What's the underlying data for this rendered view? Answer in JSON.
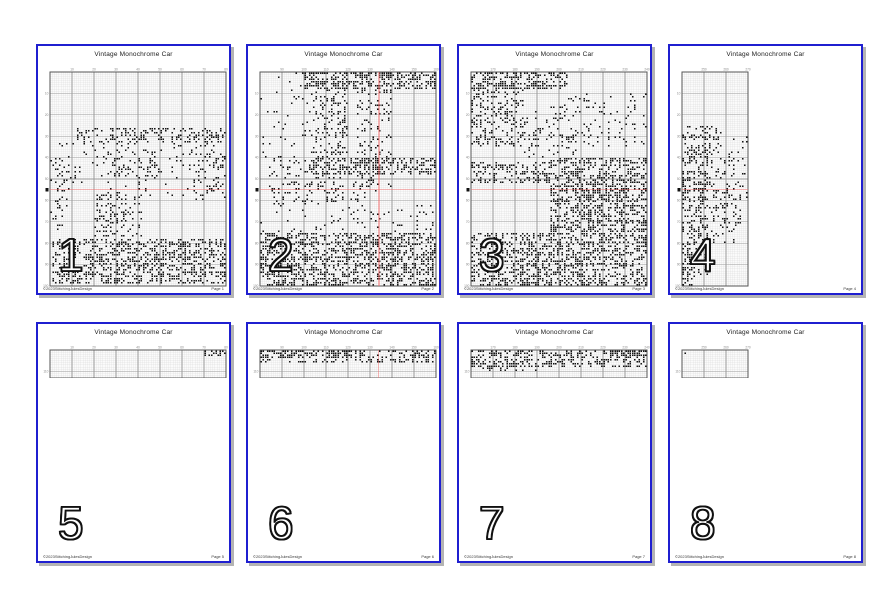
{
  "document_title": "Vintage Monochrome Car",
  "colors": {
    "page_border": "#1f1fd0",
    "grid_minor": "#dcdcdc",
    "grid_major": "#9a9a9a",
    "grid_border": "#555555",
    "stitch_mark": "#141414",
    "center_line_red": "#ef6b6b",
    "shadow": "#b4b4b4"
  },
  "pages": [
    {
      "number": "1",
      "title": "Vintage Monochrome Car",
      "footer_left": "©2023StitchingJulesDesign",
      "footer_right": "Page 1",
      "grid": {
        "cols": 80,
        "rows": 100,
        "seed": 101,
        "col_labels": [
          10,
          20,
          30,
          40,
          50,
          60,
          70,
          80
        ],
        "row_labels": [
          10,
          20,
          30,
          40,
          50,
          60,
          70,
          80,
          90,
          100
        ],
        "red_h": 0.55,
        "red_v": null,
        "left_marker": true,
        "regions": [
          [
            0.16,
            0.97,
            0.26,
            0.33,
            0.3
          ],
          [
            0.05,
            0.98,
            0.33,
            0.58,
            0.08
          ],
          [
            0.33,
            0.62,
            0.36,
            0.5,
            0.14
          ],
          [
            0.82,
            1.0,
            0.28,
            0.6,
            0.15
          ],
          [
            0.0,
            0.1,
            0.4,
            0.75,
            0.12
          ],
          [
            0.25,
            0.52,
            0.58,
            0.77,
            0.22
          ],
          [
            0.02,
            1.0,
            0.78,
            0.99,
            0.42
          ]
        ]
      }
    },
    {
      "number": "2",
      "title": "Vintage Monochrome Car",
      "footer_left": "©2023StitchingJulesDesign",
      "footer_right": "Page 2",
      "grid": {
        "cols": 80,
        "rows": 100,
        "seed": 202,
        "col_labels": [
          90,
          100,
          110,
          120,
          130,
          140,
          150,
          160
        ],
        "row_labels": [
          10,
          20,
          30,
          40,
          50,
          60,
          70,
          80,
          90,
          100
        ],
        "red_h": 0.55,
        "red_v": 0.675,
        "left_marker": true,
        "regions": [
          [
            0.25,
            1.0,
            0.0,
            0.07,
            0.5
          ],
          [
            0.3,
            0.5,
            0.02,
            0.4,
            0.25
          ],
          [
            0.55,
            0.75,
            0.0,
            0.55,
            0.16
          ],
          [
            0.05,
            0.6,
            0.4,
            0.62,
            0.14
          ],
          [
            0.3,
            1.0,
            0.4,
            0.48,
            0.4
          ],
          [
            0.0,
            0.3,
            0.0,
            0.4,
            0.05
          ],
          [
            0.0,
            1.0,
            0.62,
            0.75,
            0.07
          ],
          [
            0.0,
            1.0,
            0.75,
            1.0,
            0.45
          ]
        ]
      }
    },
    {
      "number": "3",
      "title": "Vintage Monochrome Car",
      "footer_left": "©2023StitchingJulesDesign",
      "footer_right": "Page 3",
      "grid": {
        "cols": 80,
        "rows": 100,
        "seed": 303,
        "col_labels": [
          170,
          180,
          190,
          200,
          210,
          220,
          230,
          240
        ],
        "row_labels": [
          10,
          20,
          30,
          40,
          50,
          60,
          70,
          80,
          90,
          100
        ],
        "red_h": 0.55,
        "red_v": null,
        "left_marker": true,
        "regions": [
          [
            0.0,
            0.55,
            0.0,
            0.07,
            0.5
          ],
          [
            0.0,
            0.3,
            0.05,
            0.35,
            0.3
          ],
          [
            0.3,
            0.6,
            0.15,
            0.4,
            0.12
          ],
          [
            0.55,
            1.0,
            0.1,
            0.35,
            0.1
          ],
          [
            0.45,
            1.0,
            0.4,
            0.75,
            0.45
          ],
          [
            0.0,
            0.45,
            0.42,
            0.52,
            0.35
          ],
          [
            0.0,
            1.0,
            0.75,
            1.0,
            0.45
          ]
        ]
      }
    },
    {
      "number": "4",
      "title": "Vintage Monochrome Car",
      "footer_left": "©2023StitchingJulesDesign",
      "footer_right": "Page 4",
      "grid": {
        "cols": 30,
        "rows": 100,
        "seed": 404,
        "col_labels": [
          250,
          260,
          270
        ],
        "row_labels": [
          10,
          20,
          30,
          40,
          50,
          60,
          70,
          80,
          90,
          100
        ],
        "red_h": 0.55,
        "red_v": null,
        "left_marker": true,
        "regions": [
          [
            0.0,
            0.6,
            0.25,
            0.32,
            0.3
          ],
          [
            0.0,
            1.0,
            0.3,
            0.6,
            0.16
          ],
          [
            0.0,
            0.4,
            0.35,
            0.95,
            0.3
          ],
          [
            0.4,
            0.9,
            0.55,
            0.8,
            0.2
          ],
          [
            0.0,
            0.2,
            0.8,
            1.0,
            0.35
          ]
        ]
      }
    },
    {
      "number": "5",
      "title": "Vintage Monochrome Car",
      "footer_left": "©2023StitchingJulesDesign",
      "footer_right": "Page 5",
      "grid": {
        "cols": 80,
        "rows": 13,
        "seed": 505,
        "col_labels": [
          10,
          20,
          30,
          40,
          50,
          60,
          70,
          80
        ],
        "row_labels": [
          110
        ],
        "red_h": null,
        "red_v": null,
        "left_marker": false,
        "regions": [
          [
            0.88,
            1.0,
            0.0,
            0.18,
            0.5
          ]
        ]
      }
    },
    {
      "number": "6",
      "title": "Vintage Monochrome Car",
      "footer_left": "©2023StitchingJulesDesign",
      "footer_right": "Page 6",
      "grid": {
        "cols": 80,
        "rows": 13,
        "seed": 606,
        "col_labels": [
          90,
          100,
          110,
          120,
          130,
          140,
          150,
          160
        ],
        "row_labels": [
          110
        ],
        "red_h": null,
        "red_v": 0.675,
        "left_marker": false,
        "regions": [
          [
            0.0,
            1.0,
            0.0,
            0.45,
            0.3
          ],
          [
            0.0,
            0.55,
            0.0,
            0.3,
            0.45
          ]
        ]
      }
    },
    {
      "number": "7",
      "title": "Vintage Monochrome Car",
      "footer_left": "©2023StitchingJulesDesign",
      "footer_right": "Page 7",
      "grid": {
        "cols": 80,
        "rows": 13,
        "seed": 707,
        "col_labels": [
          170,
          180,
          190,
          200,
          210,
          220,
          230,
          240
        ],
        "row_labels": [
          110
        ],
        "red_h": null,
        "red_v": null,
        "left_marker": false,
        "regions": [
          [
            0.0,
            1.0,
            0.0,
            0.55,
            0.42
          ],
          [
            0.0,
            0.4,
            0.55,
            0.75,
            0.2
          ],
          [
            0.78,
            1.0,
            0.0,
            0.2,
            0.6
          ]
        ]
      }
    },
    {
      "number": "8",
      "title": "Vintage Monochrome Car",
      "footer_left": "©2023StitchingJulesDesign",
      "footer_right": "Page 8",
      "grid": {
        "cols": 30,
        "rows": 13,
        "seed": 808,
        "col_labels": [
          250,
          260,
          270
        ],
        "row_labels": [
          110
        ],
        "red_h": null,
        "red_v": null,
        "left_marker": false,
        "regions": [
          [
            0.0,
            0.08,
            0.0,
            0.45,
            0.25
          ]
        ]
      }
    }
  ]
}
